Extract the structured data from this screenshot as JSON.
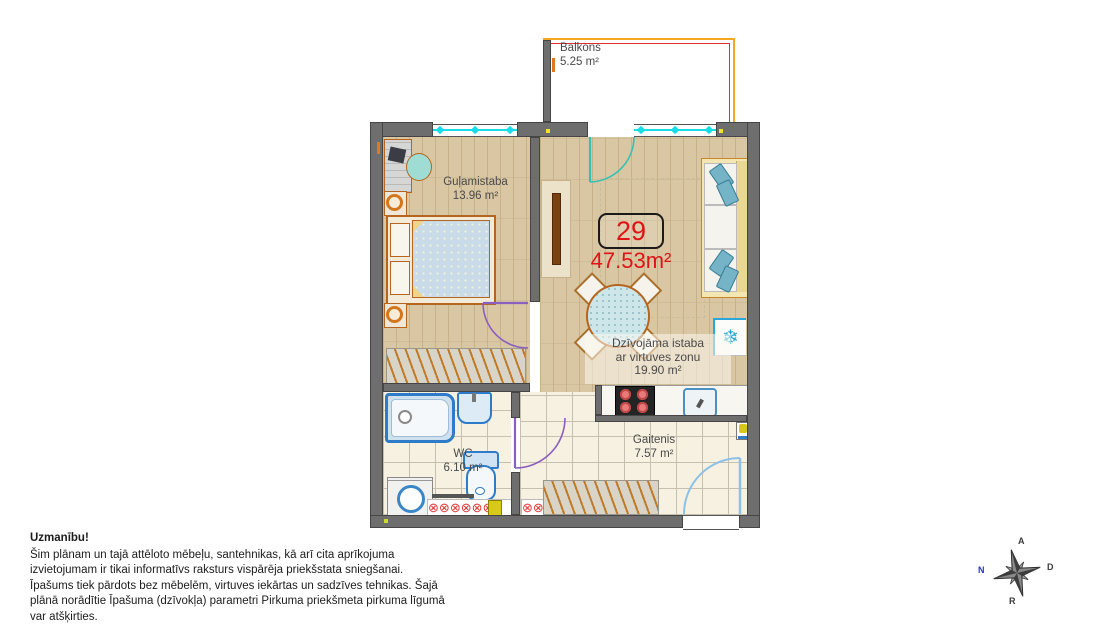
{
  "plan": {
    "apartment_number": "29",
    "total_area": "47.53m²",
    "rooms": {
      "balcony": {
        "name": "Balkons",
        "area": "5.25 m²"
      },
      "bedroom": {
        "name": "Guļamistaba",
        "area": "13.96 m²"
      },
      "living": {
        "name_line1": "Dzīvojāma istaba",
        "name_line2": "ar virtuves zonu",
        "area": "19.90 m²"
      },
      "wc": {
        "name": "WC",
        "area": "6.10 m²"
      },
      "hallway": {
        "name": "Gaitenis",
        "area": "7.57 m²"
      }
    }
  },
  "disclaimer": {
    "title": "Uzmanību!",
    "body": "Šim plānam un tajā attēloto mēbeļu, santehnikas, kā arī cita aprīkojuma izvietojumam ir tikai informatīvs raksturs vispārēja priekšstata sniegšanai. Īpašums tiek pārdots bez mēbelēm, virtuves iekārtas un sadzīves tehnikas. Šajā plānā norādītie Īpašuma (dzīvokļa) parametri Pirkuma priekšmeta pirkuma līgumā var atšķirties."
  },
  "compass": {
    "north": "N",
    "east": "A",
    "south": "D",
    "west": "R"
  },
  "icons": {
    "snowflake": "❄",
    "radiator": "⊗"
  },
  "colors": {
    "accent_red": "#e01414",
    "wall_gray": "#6e6e6e",
    "window_cyan": "#17dde8",
    "balcony_orange": "#f5a71f",
    "door_purple": "#8a5fc0",
    "entrance_blue": "#8cc1e8",
    "fixture_blue": "#2e7cc9"
  }
}
